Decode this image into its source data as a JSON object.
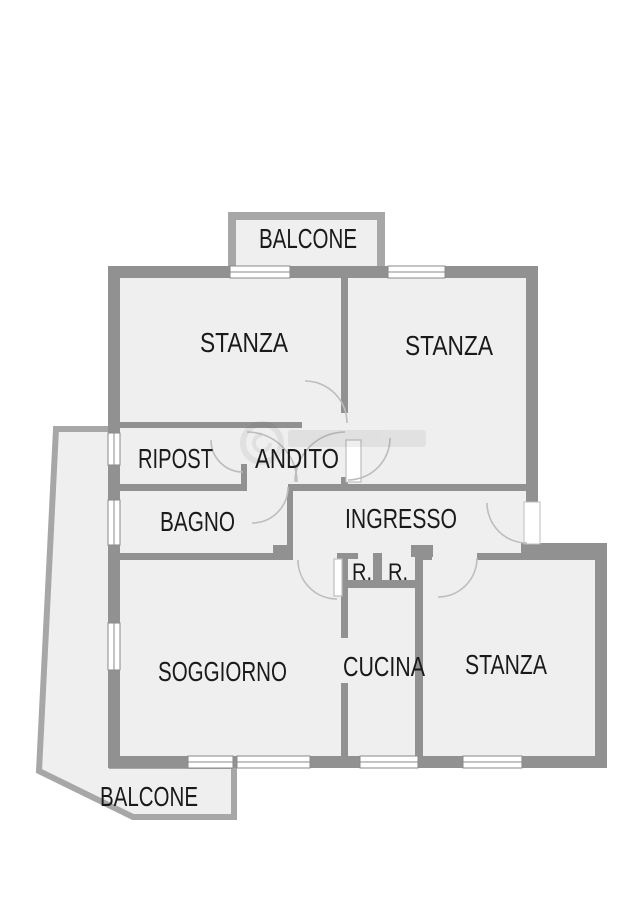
{
  "plan": {
    "type": "apartment-floor-plan",
    "rooms": [
      {
        "id": "balcone-top",
        "label": "BALCONE"
      },
      {
        "id": "stanza-top-left",
        "label": "STANZA"
      },
      {
        "id": "stanza-top-right",
        "label": "STANZA"
      },
      {
        "id": "ripost",
        "label": "RIPOST"
      },
      {
        "id": "andito",
        "label": "ANDITO"
      },
      {
        "id": "bagno",
        "label": "BAGNO"
      },
      {
        "id": "ingresso",
        "label": "INGRESSO"
      },
      {
        "id": "closet-left",
        "label": "R."
      },
      {
        "id": "closet-right",
        "label": "R."
      },
      {
        "id": "soggiorno",
        "label": "SOGGIORNO"
      },
      {
        "id": "cucina",
        "label": "CUCINA"
      },
      {
        "id": "stanza-bottom-right",
        "label": "STANZA"
      },
      {
        "id": "balcone-bottom",
        "label": "BALCONE"
      }
    ],
    "icons": [
      {
        "name": "watermark-logo-icon",
        "description": "faint circular agency watermark behind ANDITO"
      }
    ],
    "colors": {
      "wall": "#919191",
      "balcony_wall": "#a7a7a7",
      "floor": "#efeff0",
      "background": "#ffffff",
      "text": "#1a1a1a",
      "door_arc": "#bdbdbd"
    }
  }
}
